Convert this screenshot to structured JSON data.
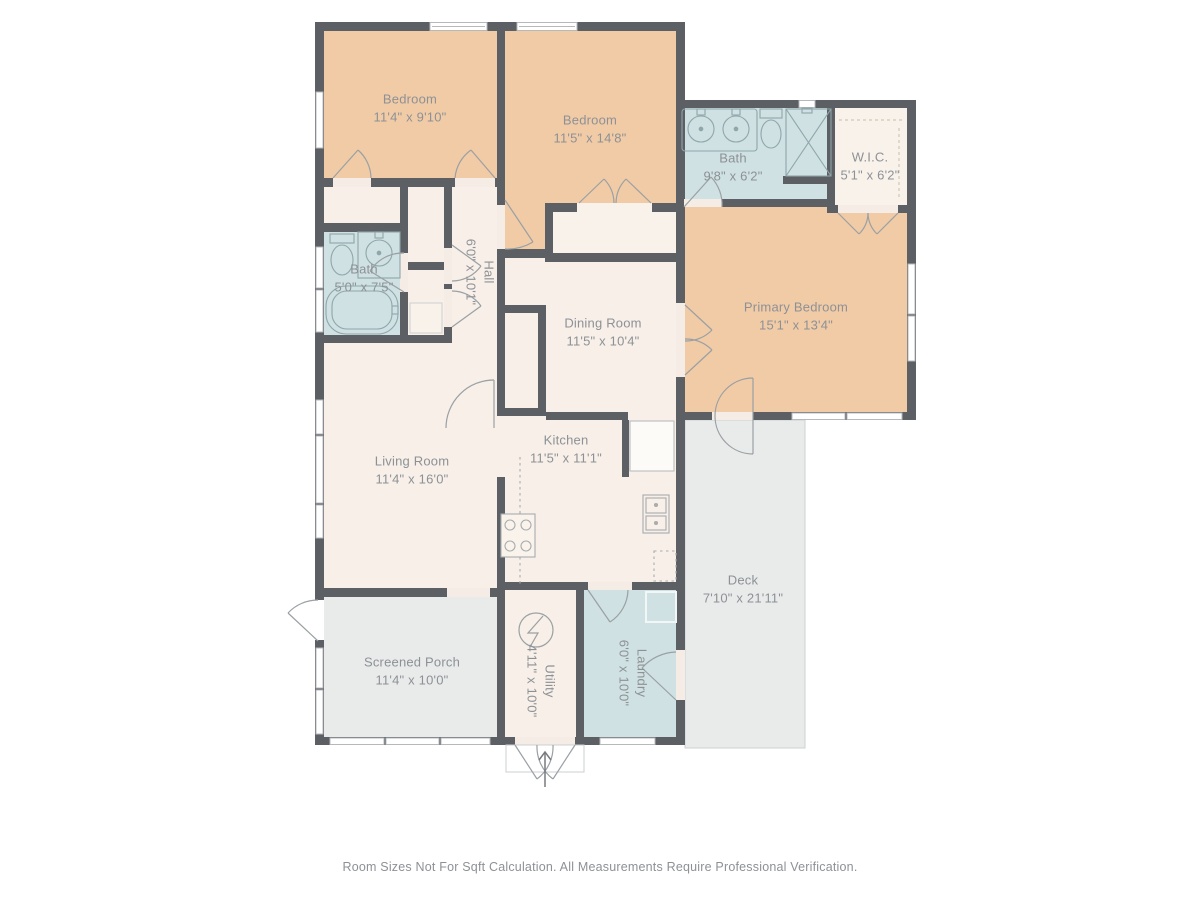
{
  "footer": {
    "disclaimer": "Room Sizes Not For Sqft Calculation. All Measurements Require Professional Verification."
  },
  "palette": {
    "wall": "#5c6064",
    "bedroom_fill": "#f1cba6",
    "bath_fill": "#cfe1e2",
    "floor_fill": "#f7efe8",
    "closet_fill": "#f8f2eb",
    "deck_fill": "#e9ebeb",
    "label_text": "#8d9196",
    "door_stroke": "#9aa0a4",
    "window_border": "#b5b9bb",
    "fixture_stroke": "#8fa6ab"
  },
  "rooms": {
    "bedroom1": {
      "name": "Bedroom",
      "dims": "11'4\" x 9'10\""
    },
    "bedroom2": {
      "name": "Bedroom",
      "dims": "11'5\" x 14'8\""
    },
    "bath_upper": {
      "name": "Bath",
      "dims": "9'8\" x 6'2\""
    },
    "wic": {
      "name": "W.I.C.",
      "dims": "5'1\" x 6'2\""
    },
    "primary": {
      "name": "Primary Bedroom",
      "dims": "15'1\" x 13'4\""
    },
    "hall": {
      "name": "Hall",
      "dims": "6'0\" x 10'1\""
    },
    "bath_lower": {
      "name": "Bath",
      "dims": "5'0\" x 7'5\""
    },
    "dining": {
      "name": "Dining Room",
      "dims": "11'5\" x 10'4\""
    },
    "living": {
      "name": "Living Room",
      "dims": "11'4\" x 16'0\""
    },
    "kitchen": {
      "name": "Kitchen",
      "dims": "11'5\" x 11'1\""
    },
    "deck": {
      "name": "Deck",
      "dims": "7'10\" x 21'11\""
    },
    "porch": {
      "name": "Screened Porch",
      "dims": "11'4\" x 10'0\""
    },
    "utility": {
      "name": "Utility",
      "dims": "4'11\" x 10'0\""
    },
    "laundry": {
      "name": "Laundry",
      "dims": "6'0\" x 10'0\""
    }
  }
}
